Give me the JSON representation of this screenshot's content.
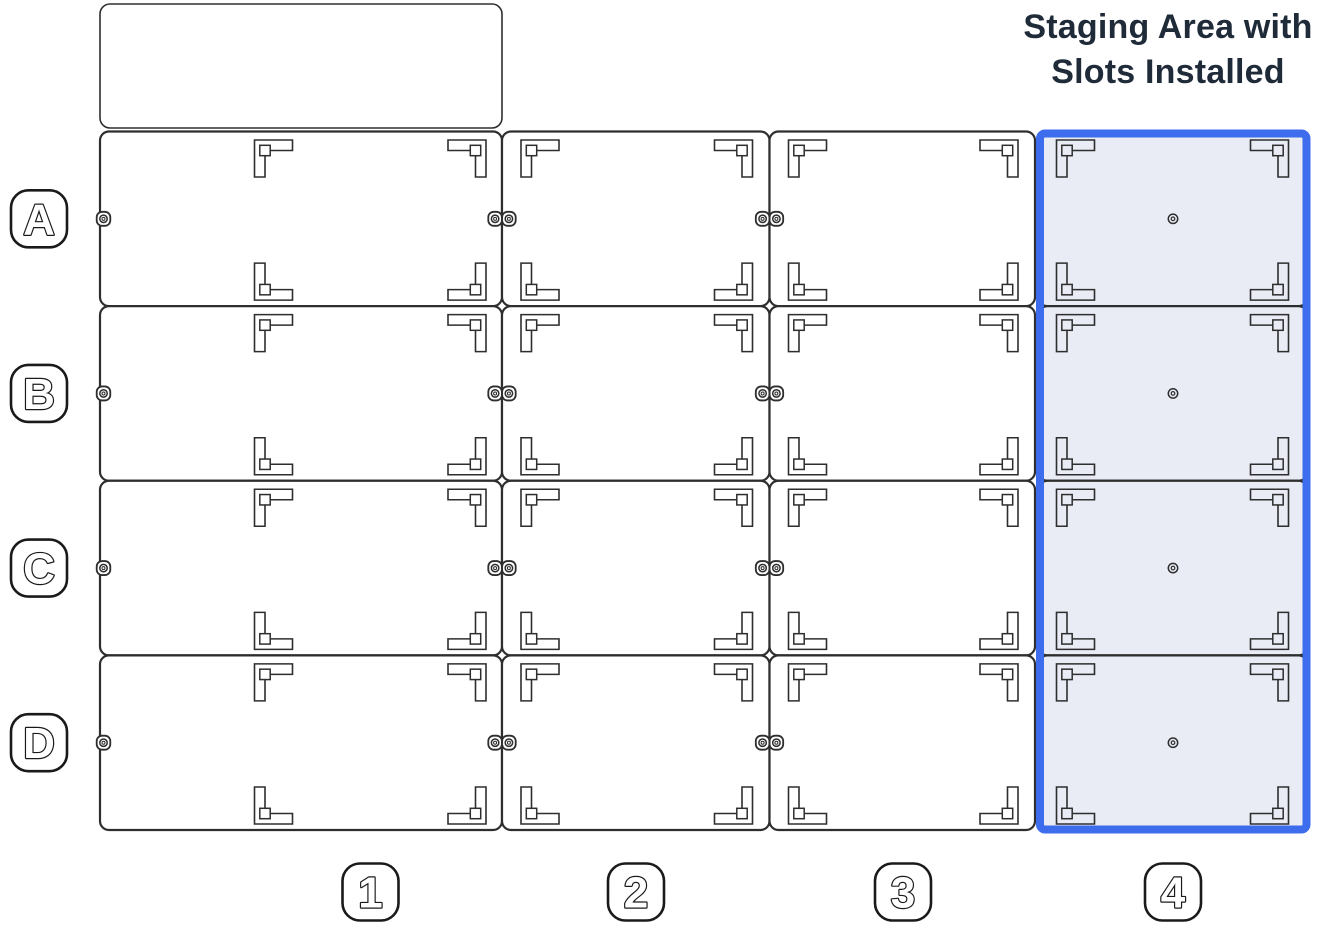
{
  "title": {
    "line1": "Staging Area with",
    "line2": "Slots Installed"
  },
  "diagram": {
    "row_labels": [
      "A",
      "B",
      "C",
      "D"
    ],
    "col_labels": [
      "1",
      "2",
      "3",
      "4"
    ],
    "highlighted_column_label": "4",
    "highlight_caption": "Staging Area with Slots Installed",
    "columns": [
      {
        "label": "1",
        "slots": 4,
        "wide_panel": true,
        "top_blank_panel": true,
        "left_edge_grommets": true,
        "right_edge_grommet_pairs": true,
        "center_holes": false,
        "highlighted": false
      },
      {
        "label": "2",
        "slots": 4,
        "wide_panel": false,
        "top_blank_panel": false,
        "left_edge_grommets": false,
        "right_edge_grommet_pairs": true,
        "center_holes": false,
        "highlighted": false
      },
      {
        "label": "3",
        "slots": 4,
        "wide_panel": false,
        "top_blank_panel": false,
        "left_edge_grommets": false,
        "right_edge_grommet_pairs": false,
        "center_holes": false,
        "highlighted": false
      },
      {
        "label": "4",
        "slots": 4,
        "wide_panel": false,
        "top_blank_panel": false,
        "left_edge_grommets": false,
        "right_edge_grommet_pairs": false,
        "center_holes": true,
        "highlighted": true
      }
    ]
  },
  "icons": {
    "corner_bracket": "slot-corner-bracket-icon",
    "grommet": "grommet-icon",
    "grommet_pair": "grommet-pair-icon",
    "center_hole": "center-hole-icon"
  },
  "colors": {
    "background": "#FFFFFF",
    "panel_fill": "#FFFFFF",
    "panel_stroke": "#2E2E2E",
    "label_stroke": "#1A1A1A",
    "highlight_border": "#3D6CEC",
    "highlight_fill": "#E9ECF5",
    "title_text": "#202B3A"
  }
}
